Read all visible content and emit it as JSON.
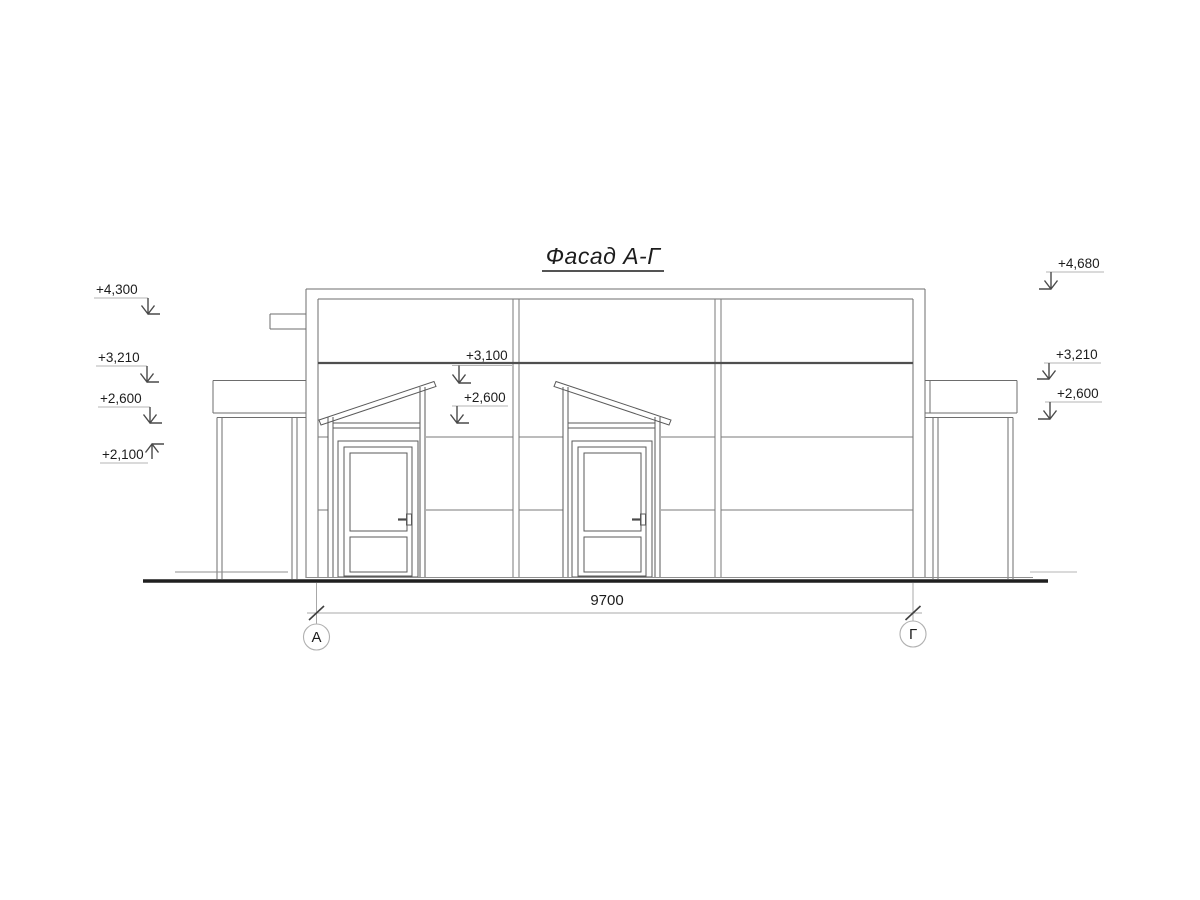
{
  "drawing": {
    "title": "Фасад А-Г",
    "elevation_marks": {
      "left": [
        {
          "label": "+4,300"
        },
        {
          "label": "+3,210"
        },
        {
          "label": "+2,600"
        },
        {
          "label": "+2,100"
        }
      ],
      "middle": [
        {
          "label": "+3,100"
        },
        {
          "label": "+2,600"
        }
      ],
      "right": [
        {
          "label": "+4,680"
        },
        {
          "label": "+3,210"
        },
        {
          "label": "+2,600"
        }
      ]
    },
    "dimension": {
      "value": "9700"
    },
    "axes": {
      "left": "А",
      "right": "Г"
    }
  }
}
